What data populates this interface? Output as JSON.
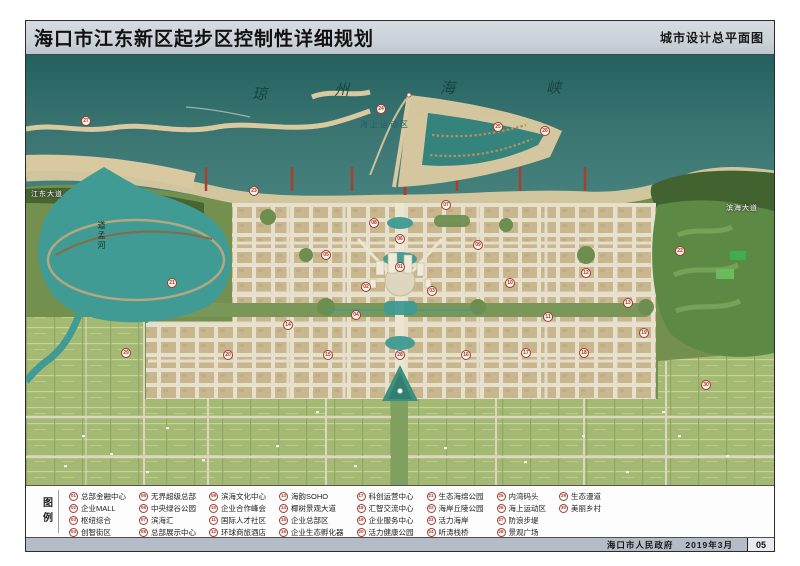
{
  "header": {
    "title": "海口市江东新区起步区控制性详细规划",
    "subtitle": "城市设计总平面图"
  },
  "map": {
    "sea_name": "琼州海峡",
    "sea_name_chars": [
      {
        "ch": "琼",
        "x": 226,
        "y": 28
      },
      {
        "ch": "州",
        "x": 308,
        "y": 24
      },
      {
        "ch": "海",
        "x": 414,
        "y": 22
      },
      {
        "ch": "峡",
        "x": 520,
        "y": 22
      }
    ],
    "labels": [
      {
        "text": "海上运动区",
        "x": 334,
        "y": 64,
        "cls": "sea-area"
      },
      {
        "text": "道孟河",
        "x": 70,
        "y": 166,
        "cls": "river"
      },
      {
        "text": "江东大道",
        "x": 5,
        "y": 134,
        "cls": "road"
      },
      {
        "text": "滨海大道",
        "x": 700,
        "y": 148,
        "cls": "road"
      }
    ],
    "markers": [
      {
        "num": "27",
        "x": 60,
        "y": 66
      },
      {
        "num": "24",
        "x": 355,
        "y": 54
      },
      {
        "num": "25",
        "x": 472,
        "y": 72
      },
      {
        "num": "26",
        "x": 519,
        "y": 76
      },
      {
        "num": "23",
        "x": 228,
        "y": 136
      },
      {
        "num": "08",
        "x": 348,
        "y": 168
      },
      {
        "num": "07",
        "x": 420,
        "y": 150
      },
      {
        "num": "06",
        "x": 374,
        "y": 184
      },
      {
        "num": "01",
        "x": 374,
        "y": 212
      },
      {
        "num": "02",
        "x": 340,
        "y": 232
      },
      {
        "num": "03",
        "x": 406,
        "y": 236
      },
      {
        "num": "04",
        "x": 330,
        "y": 260
      },
      {
        "num": "05",
        "x": 300,
        "y": 200
      },
      {
        "num": "09",
        "x": 452,
        "y": 190
      },
      {
        "num": "10",
        "x": 484,
        "y": 228
      },
      {
        "num": "11",
        "x": 522,
        "y": 262
      },
      {
        "num": "12",
        "x": 560,
        "y": 218
      },
      {
        "num": "13",
        "x": 602,
        "y": 248
      },
      {
        "num": "14",
        "x": 262,
        "y": 270
      },
      {
        "num": "15",
        "x": 302,
        "y": 300
      },
      {
        "num": "16",
        "x": 440,
        "y": 300
      },
      {
        "num": "17",
        "x": 500,
        "y": 298
      },
      {
        "num": "18",
        "x": 558,
        "y": 298
      },
      {
        "num": "19",
        "x": 618,
        "y": 278
      },
      {
        "num": "20",
        "x": 202,
        "y": 300
      },
      {
        "num": "21",
        "x": 146,
        "y": 228
      },
      {
        "num": "22",
        "x": 654,
        "y": 196
      },
      {
        "num": "28",
        "x": 374,
        "y": 300
      },
      {
        "num": "29",
        "x": 100,
        "y": 298
      },
      {
        "num": "30",
        "x": 680,
        "y": 330
      }
    ]
  },
  "legend": {
    "label": "图例",
    "items": [
      {
        "num": "01",
        "label": "总部金融中心"
      },
      {
        "num": "02",
        "label": "企业MALL"
      },
      {
        "num": "03",
        "label": "枢纽综合"
      },
      {
        "num": "04",
        "label": "创智街区"
      },
      {
        "num": "05",
        "label": "无界超级总部"
      },
      {
        "num": "06",
        "label": "中央绿谷公园"
      },
      {
        "num": "07",
        "label": "滨海汇"
      },
      {
        "num": "08",
        "label": "总部展示中心"
      },
      {
        "num": "09",
        "label": "滨海文化中心"
      },
      {
        "num": "10",
        "label": "企业合作峰会"
      },
      {
        "num": "11",
        "label": "国际人才社区"
      },
      {
        "num": "12",
        "label": "环球商旅酒店"
      },
      {
        "num": "13",
        "label": "海韵SOHO"
      },
      {
        "num": "14",
        "label": "椰树景观大道"
      },
      {
        "num": "15",
        "label": "企业总部区"
      },
      {
        "num": "16",
        "label": "企业生态孵化器"
      },
      {
        "num": "17",
        "label": "科创运营中心"
      },
      {
        "num": "18",
        "label": "汇智交流中心"
      },
      {
        "num": "19",
        "label": "企业服务中心"
      },
      {
        "num": "20",
        "label": "活力健康公园"
      },
      {
        "num": "21",
        "label": "生态海绵公园"
      },
      {
        "num": "22",
        "label": "海岸丘陵公园"
      },
      {
        "num": "23",
        "label": "活力海岸"
      },
      {
        "num": "24",
        "label": "听涛栈桥"
      },
      {
        "num": "25",
        "label": "内湾码头"
      },
      {
        "num": "26",
        "label": "海上运动区"
      },
      {
        "num": "27",
        "label": "防浪步堤"
      },
      {
        "num": "28",
        "label": "景观广场"
      },
      {
        "num": "29",
        "label": "生态漫道"
      },
      {
        "num": "30",
        "label": "美丽乡村"
      }
    ]
  },
  "footer": {
    "issuer": "海口市人民政府",
    "date": "2019年3月",
    "page_no": "05"
  },
  "colors": {
    "header_bg": "#ccd2d8",
    "footer_bg": "#b4bdc7",
    "frame_border": "#2b2b2b",
    "sea_deep": "#2a6e6b",
    "sand": "#d9c9a0",
    "forest": "#42622f",
    "land": "#74904f",
    "farmland": "#a4ba74",
    "field_line": "#c6d494",
    "urban_block": "#c8b68f",
    "road": "#e7e0cc",
    "pond": "#3f9b93",
    "marker_red": "#a3392b",
    "legend_text": "#222222"
  }
}
